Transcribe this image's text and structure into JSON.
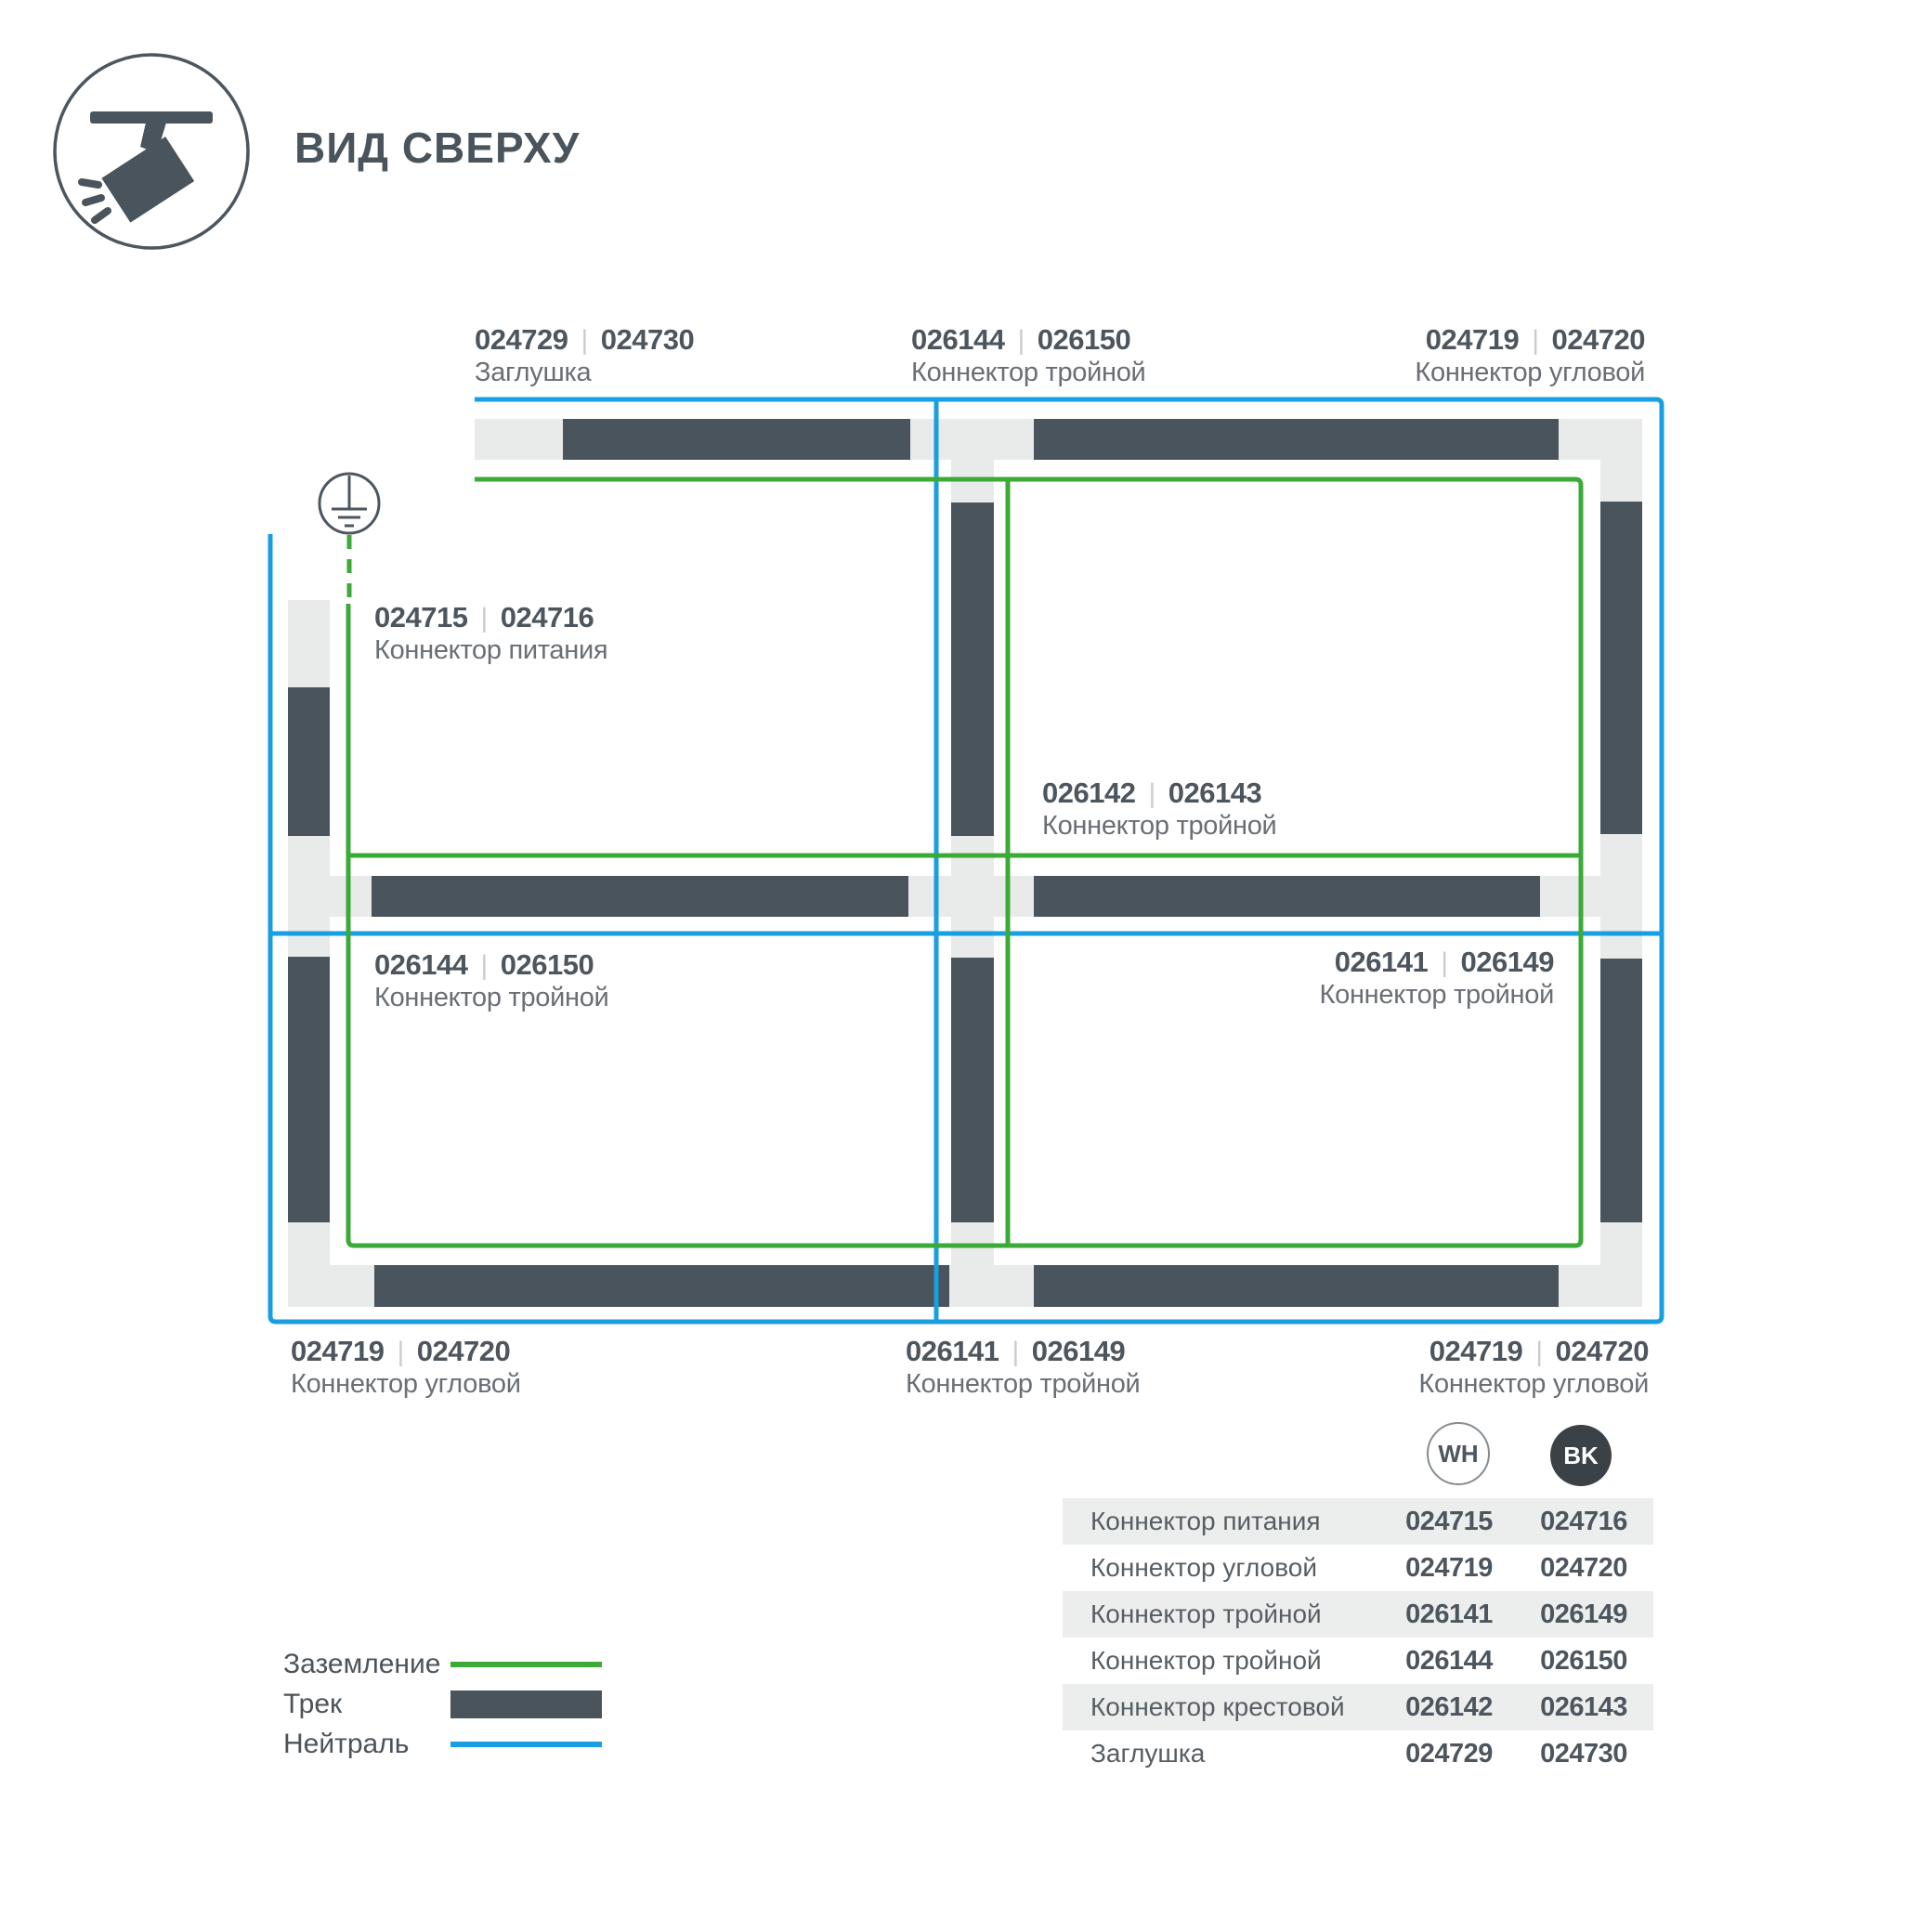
{
  "header": {
    "title": "ВИД СВЕРХУ"
  },
  "ui": {
    "separator": "|"
  },
  "icons": {
    "header_icon": "track-spotlight-icon",
    "ground_icon": "earth-ground-symbol"
  },
  "colors": {
    "track_dark": "#4a545c",
    "track_base": "#e9eaea",
    "ground_green": "#3caa36",
    "neutral_blue": "#189fe2",
    "code_text": "#4d565e",
    "name_text": "#696f75"
  },
  "diagram": {
    "labels": [
      {
        "code_wh": "024729",
        "code_bk": "024730",
        "name": "Заглушка"
      },
      {
        "code_wh": "026144",
        "code_bk": "026150",
        "name": "Коннектор тройной"
      },
      {
        "code_wh": "024719",
        "code_bk": "024720",
        "name": "Коннектор угловой"
      },
      {
        "code_wh": "024715",
        "code_bk": "024716",
        "name": "Коннектор питания"
      },
      {
        "code_wh": "026142",
        "code_bk": "026143",
        "name": "Коннектор тройной"
      },
      {
        "code_wh": "026144",
        "code_bk": "026150",
        "name": "Коннектор тройной"
      },
      {
        "code_wh": "026141",
        "code_bk": "026149",
        "name": "Коннектор тройной"
      },
      {
        "code_wh": "024719",
        "code_bk": "024720",
        "name": "Коннектор угловой"
      },
      {
        "code_wh": "026141",
        "code_bk": "026149",
        "name": "Коннектор тройной"
      },
      {
        "code_wh": "024719",
        "code_bk": "024720",
        "name": "Коннектор угловой"
      }
    ]
  },
  "legend": {
    "items": [
      {
        "label": "Заземление"
      },
      {
        "label": "Трек"
      },
      {
        "label": "Нейтраль"
      }
    ]
  },
  "table": {
    "badges": [
      "WH",
      "BK"
    ],
    "rows": [
      {
        "name": "Коннектор питания",
        "wh": "024715",
        "bk": "024716"
      },
      {
        "name": "Коннектор угловой",
        "wh": "024719",
        "bk": "024720"
      },
      {
        "name": "Коннектор тройной",
        "wh": "026141",
        "bk": "026149"
      },
      {
        "name": "Коннектор тройной",
        "wh": "026144",
        "bk": "026150"
      },
      {
        "name": "Коннектор крестовой",
        "wh": "026142",
        "bk": "026143"
      },
      {
        "name": "Заглушка",
        "wh": "024729",
        "bk": "024730"
      }
    ]
  }
}
